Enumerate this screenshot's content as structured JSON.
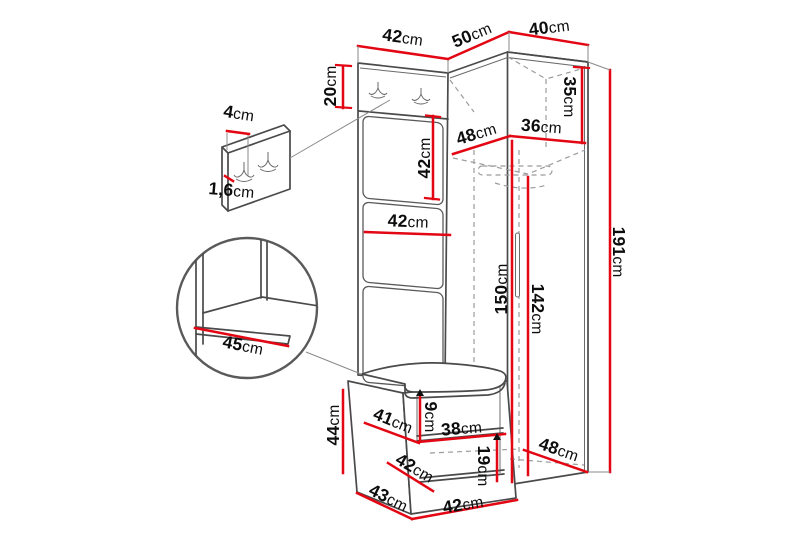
{
  "figure": {
    "type": "furniture-dimension-diagram",
    "subject": "hallway wardrobe set with coat hooks, corner wardrobe and shoe bench",
    "measurement_unit": "cm"
  },
  "colors": {
    "dimension_red": "#e30613",
    "outline_gray": "#4a4a4a",
    "hidden_edge_gray": "#9b9b9b",
    "text_black": "#0d0d0d",
    "background": "#ffffff"
  },
  "dims": {
    "top_width_left": {
      "value": "42",
      "unit": "cm"
    },
    "top_width_corner": {
      "value": "50",
      "unit": "cm"
    },
    "top_width_right": {
      "value": "40",
      "unit": "cm"
    },
    "hook_panel_height": {
      "value": "20",
      "unit": "cm"
    },
    "upper_panel_height": {
      "value": "42",
      "unit": "cm"
    },
    "panel_width": {
      "value": "42",
      "unit": "cm"
    },
    "shelf_depth_left": {
      "value": "48",
      "unit": "cm"
    },
    "shelf_depth_right": {
      "value": "36",
      "unit": "cm"
    },
    "top_shelf_height": {
      "value": "35",
      "unit": "cm"
    },
    "interior_height": {
      "value": "150",
      "unit": "cm"
    },
    "hanging_height": {
      "value": "142",
      "unit": "cm"
    },
    "total_height": {
      "value": "191",
      "unit": "cm"
    },
    "hook_board_width": {
      "value": "4",
      "unit": "cm"
    },
    "hook_board_thickness": {
      "value": "1,6",
      "unit": "cm"
    },
    "seat_detail_depth": {
      "value": "45",
      "unit": "cm"
    },
    "bench_height": {
      "value": "44",
      "unit": "cm"
    },
    "seat_top_depth": {
      "value": "41",
      "unit": "cm"
    },
    "seat_gap_height": {
      "value": "9",
      "unit": "cm"
    },
    "bench_shelf_width": {
      "value": "38",
      "unit": "cm"
    },
    "mid_shelf_depth": {
      "value": "42",
      "unit": "cm"
    },
    "lower_gap_height": {
      "value": "19",
      "unit": "cm"
    },
    "bench_depth": {
      "value": "43",
      "unit": "cm"
    },
    "bench_bottom_width": {
      "value": "42",
      "unit": "cm"
    },
    "wardrobe_depth": {
      "value": "48",
      "unit": "cm"
    }
  }
}
